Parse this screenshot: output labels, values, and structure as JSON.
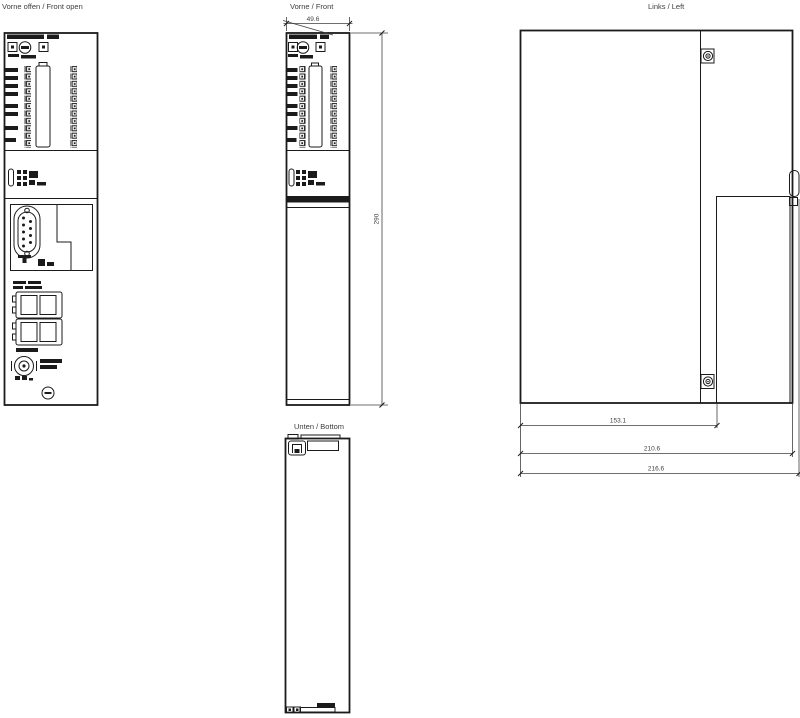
{
  "page": {
    "background": "#ffffff",
    "line_color": "#1b1b1b",
    "text_color": "#3c3c3c"
  },
  "views": {
    "front_open": {
      "label": "Vorne offen / Front open"
    },
    "front": {
      "label": "Vorne / Front"
    },
    "left": {
      "label": "Links / Left"
    },
    "bottom": {
      "label": "Unten / Bottom"
    }
  },
  "dimensions": {
    "front_width": "49.6",
    "front_height": "290",
    "depth_front": "153.1",
    "depth_body": "210.6",
    "depth_total": "216.6"
  }
}
